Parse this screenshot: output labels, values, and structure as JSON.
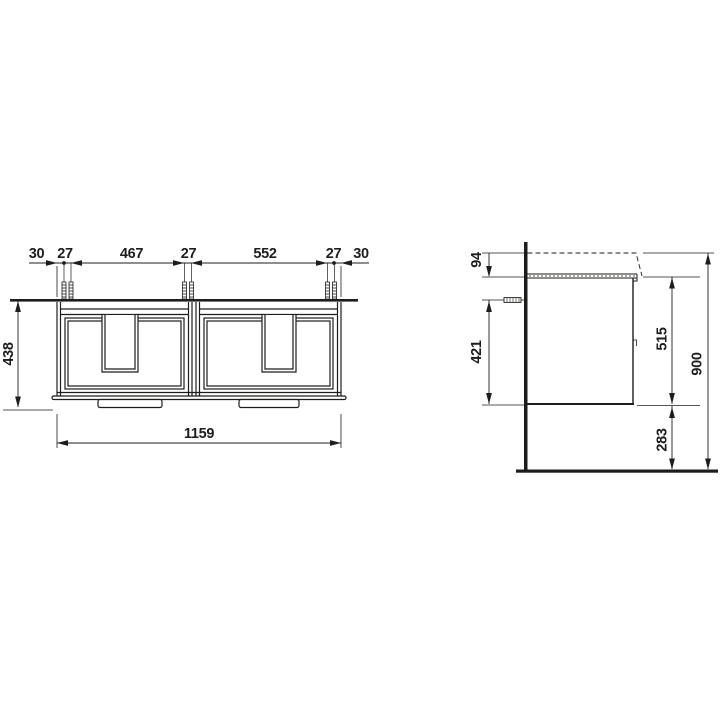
{
  "front_view": {
    "top_dims": [
      "30",
      "27",
      "467",
      "27",
      "552",
      "27",
      "30"
    ],
    "height": "438",
    "width": "1159"
  },
  "side_view": {
    "basin_overhang": "94",
    "fixing_height": "421",
    "cabinet_height": "515",
    "plinth_clearance": "283",
    "total_height": "900"
  },
  "colors": {
    "line": "#1d1d1b",
    "background": "#ffffff"
  }
}
